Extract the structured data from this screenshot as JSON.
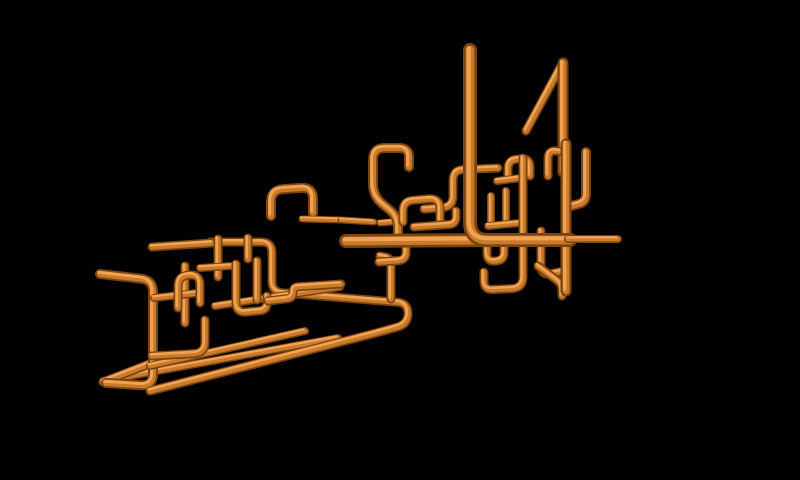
{
  "scene": {
    "kind": "3d-pipes-screensaver-render",
    "background": "#000000",
    "canvas": {
      "width": 800,
      "height": 480
    }
  },
  "palette": {
    "pipe_edge_dark": "#7a4312",
    "pipe_mid_orange": "#c97a2a",
    "pipe_highlight": "#f0a351",
    "background": "#000000"
  },
  "pipe_style": {
    "mid_width_ratio": 0.62,
    "highlight_width_ratio": 0.3,
    "highlight_offset_x": -1.3,
    "highlight_offset_y": -1.7,
    "corner_radius_ratio": 1.2
  },
  "pipes": [
    {
      "name": "pipe-left-far-diagonal",
      "w": 8,
      "pts": [
        [
          103,
          381
        ],
        [
          338,
          338
        ]
      ]
    },
    {
      "name": "pipe-left-apex-diagonal",
      "w": 9,
      "pts": [
        [
          103,
          382
        ],
        [
          152,
          363
        ]
      ]
    },
    {
      "name": "pipe-left-big-bracket",
      "w": 10,
      "pts": [
        [
          100,
          274
        ],
        [
          153,
          280
        ],
        [
          153,
          386
        ],
        [
          106,
          383
        ]
      ]
    },
    {
      "name": "pipe-z-run-long",
      "w": 9,
      "pts": [
        [
          210,
          242
        ],
        [
          272,
          242
        ],
        [
          272,
          292
        ],
        [
          408,
          303
        ],
        [
          408,
          324
        ],
        [
          380,
          332
        ],
        [
          150,
          391
        ]
      ]
    },
    {
      "name": "pipe-left-diagonal-mid",
      "w": 8,
      "pts": [
        [
          150,
          366
        ],
        [
          305,
          331
        ]
      ]
    },
    {
      "name": "pipe-left-diagonal-upper",
      "w": 8,
      "pts": [
        [
          215,
          306
        ],
        [
          340,
          287
        ]
      ]
    },
    {
      "name": "pipe-left-top-horizontal",
      "w": 9,
      "pts": [
        [
          152,
          247
        ],
        [
          212,
          243
        ]
      ]
    },
    {
      "name": "pipe-left-vertical-218",
      "w": 9,
      "pts": [
        [
          218,
          239
        ],
        [
          218,
          277
        ]
      ]
    },
    {
      "name": "pipe-left-vertical-247",
      "w": 9,
      "pts": [
        [
          248,
          238
        ],
        [
          248,
          259
        ]
      ]
    },
    {
      "name": "pipe-left-vertical-185",
      "w": 9,
      "pts": [
        [
          185,
          266
        ],
        [
          185,
          323
        ]
      ]
    },
    {
      "name": "pipe-left-shelf",
      "w": 8,
      "pts": [
        [
          154,
          298
        ],
        [
          198,
          293
        ]
      ]
    },
    {
      "name": "pipe-left-small-arch",
      "w": 9,
      "pts": [
        [
          178,
          308
        ],
        [
          178,
          276
        ],
        [
          200,
          274
        ],
        [
          200,
          303
        ]
      ]
    },
    {
      "name": "pipe-left-mid-stub",
      "w": 8,
      "pts": [
        [
          200,
          268
        ],
        [
          232,
          266
        ]
      ]
    },
    {
      "name": "pipe-left-u-bend",
      "w": 9,
      "pts": [
        [
          236,
          264
        ],
        [
          236,
          313
        ],
        [
          267,
          310
        ],
        [
          267,
          296
        ]
      ]
    },
    {
      "name": "pipe-left-l-bend",
      "w": 9,
      "pts": [
        [
          205,
          320
        ],
        [
          205,
          353
        ],
        [
          152,
          356
        ]
      ]
    },
    {
      "name": "pipe-left-vertical-257",
      "w": 9,
      "pts": [
        [
          257,
          261
        ],
        [
          257,
          300
        ]
      ]
    },
    {
      "name": "pipe-left-step-bracket",
      "w": 9,
      "pts": [
        [
          268,
          301
        ],
        [
          293,
          298
        ],
        [
          293,
          287
        ],
        [
          341,
          284
        ]
      ]
    },
    {
      "name": "pipe-center-arch",
      "w": 10,
      "pts": [
        [
          271,
          216
        ],
        [
          271,
          190
        ],
        [
          313,
          187
        ],
        [
          313,
          213
        ]
      ]
    },
    {
      "name": "pipe-thin-runner-a",
      "w": 7,
      "pts": [
        [
          302,
          219
        ],
        [
          340,
          220
        ]
      ]
    },
    {
      "name": "pipe-thin-runner-b",
      "w": 7,
      "pts": [
        [
          341,
          220
        ],
        [
          374,
          222
        ]
      ]
    },
    {
      "name": "pipe-thin-runner-c",
      "w": 7,
      "pts": [
        [
          380,
          223
        ],
        [
          404,
          221
        ]
      ]
    },
    {
      "name": "pipe-center-elbow-riser",
      "w": 9,
      "pts": [
        [
          424,
          209
        ],
        [
          453,
          207
        ],
        [
          453,
          170
        ],
        [
          498,
          168
        ]
      ]
    },
    {
      "name": "pipe-cluster-arch-top",
      "w": 9,
      "pts": [
        [
          508,
          178
        ],
        [
          508,
          160
        ],
        [
          530,
          158
        ],
        [
          530,
          176
        ]
      ]
    },
    {
      "name": "pipe-cluster-stub-top",
      "w": 8,
      "pts": [
        [
          497,
          181
        ],
        [
          521,
          178
        ]
      ]
    },
    {
      "name": "pipe-cluster-vertical-a",
      "w": 8,
      "pts": [
        [
          491,
          196
        ],
        [
          491,
          226
        ]
      ]
    },
    {
      "name": "pipe-cluster-vertical-b",
      "w": 8,
      "pts": [
        [
          506,
          191
        ],
        [
          506,
          221
        ]
      ]
    },
    {
      "name": "pipe-cluster-crossbar",
      "w": 8,
      "pts": [
        [
          488,
          226
        ],
        [
          520,
          223
        ]
      ]
    },
    {
      "name": "pipe-cluster-long-j",
      "w": 9,
      "pts": [
        [
          523,
          158
        ],
        [
          523,
          288
        ],
        [
          484,
          290
        ],
        [
          484,
          272
        ]
      ]
    },
    {
      "name": "pipe-four-diagonal",
      "w": 9,
      "pts": [
        [
          526,
          131
        ],
        [
          561,
          66
        ]
      ]
    },
    {
      "name": "pipe-four-vertical",
      "w": 11,
      "pts": [
        [
          563,
          63
        ],
        [
          563,
          172
        ]
      ]
    },
    {
      "name": "pipe-cluster-top-elbow",
      "w": 9,
      "pts": [
        [
          566,
          152
        ],
        [
          548,
          150
        ],
        [
          548,
          176
        ]
      ]
    },
    {
      "name": "pipe-cluster-right-l",
      "w": 10,
      "pts": [
        [
          586,
          152
        ],
        [
          586,
          202
        ],
        [
          571,
          206
        ]
      ]
    },
    {
      "name": "pipe-cluster-drop-elbow",
      "w": 9,
      "pts": [
        [
          541,
          231
        ],
        [
          541,
          276
        ],
        [
          564,
          271
        ]
      ]
    },
    {
      "name": "pipe-cluster-foot-diagonal",
      "w": 9,
      "pts": [
        [
          538,
          266
        ],
        [
          562,
          284
        ],
        [
          562,
          296
        ]
      ]
    },
    {
      "name": "pipe-right-main-vertical",
      "w": 11,
      "pts": [
        [
          566,
          144
        ],
        [
          566,
          291
        ]
      ]
    },
    {
      "name": "pipe-under-trunk-u",
      "w": 9,
      "pts": [
        [
          487,
          243
        ],
        [
          487,
          262
        ],
        [
          504,
          260
        ],
        [
          504,
          246
        ]
      ]
    },
    {
      "name": "pipe-center-hook",
      "w": 10,
      "pts": [
        [
          409,
          167
        ],
        [
          409,
          148
        ],
        [
          373,
          148
        ],
        [
          373,
          196
        ],
        [
          398,
          217
        ],
        [
          398,
          238
        ]
      ]
    },
    {
      "name": "pipe-center-rect",
      "w": 9,
      "pts": [
        [
          403,
          222
        ],
        [
          403,
          201
        ],
        [
          440,
          198
        ],
        [
          440,
          221
        ]
      ]
    },
    {
      "name": "pipe-center-rect-base",
      "w": 9,
      "pts": [
        [
          414,
          227
        ],
        [
          456,
          224
        ],
        [
          456,
          211
        ]
      ]
    },
    {
      "name": "pipe-drop-left-elbow",
      "w": 9,
      "pts": [
        [
          391,
          299
        ],
        [
          391,
          258
        ],
        [
          380,
          256
        ]
      ]
    },
    {
      "name": "pipe-drop-stub",
      "w": 9,
      "pts": [
        [
          379,
          262
        ],
        [
          406,
          260
        ],
        [
          406,
          245
        ]
      ]
    },
    {
      "name": "pipe-main-trunk",
      "w": 14,
      "pts": [
        [
          346,
          241
        ],
        [
          500,
          240
        ]
      ]
    },
    {
      "name": "pipe-tall-vertical-elbow",
      "w": 14,
      "r": 18,
      "pts": [
        [
          470,
          50
        ],
        [
          470,
          240
        ],
        [
          570,
          240
        ]
      ]
    },
    {
      "name": "pipe-right-capped-arm",
      "w": 8,
      "pts": [
        [
          568,
          239
        ],
        [
          618,
          239
        ]
      ]
    }
  ]
}
